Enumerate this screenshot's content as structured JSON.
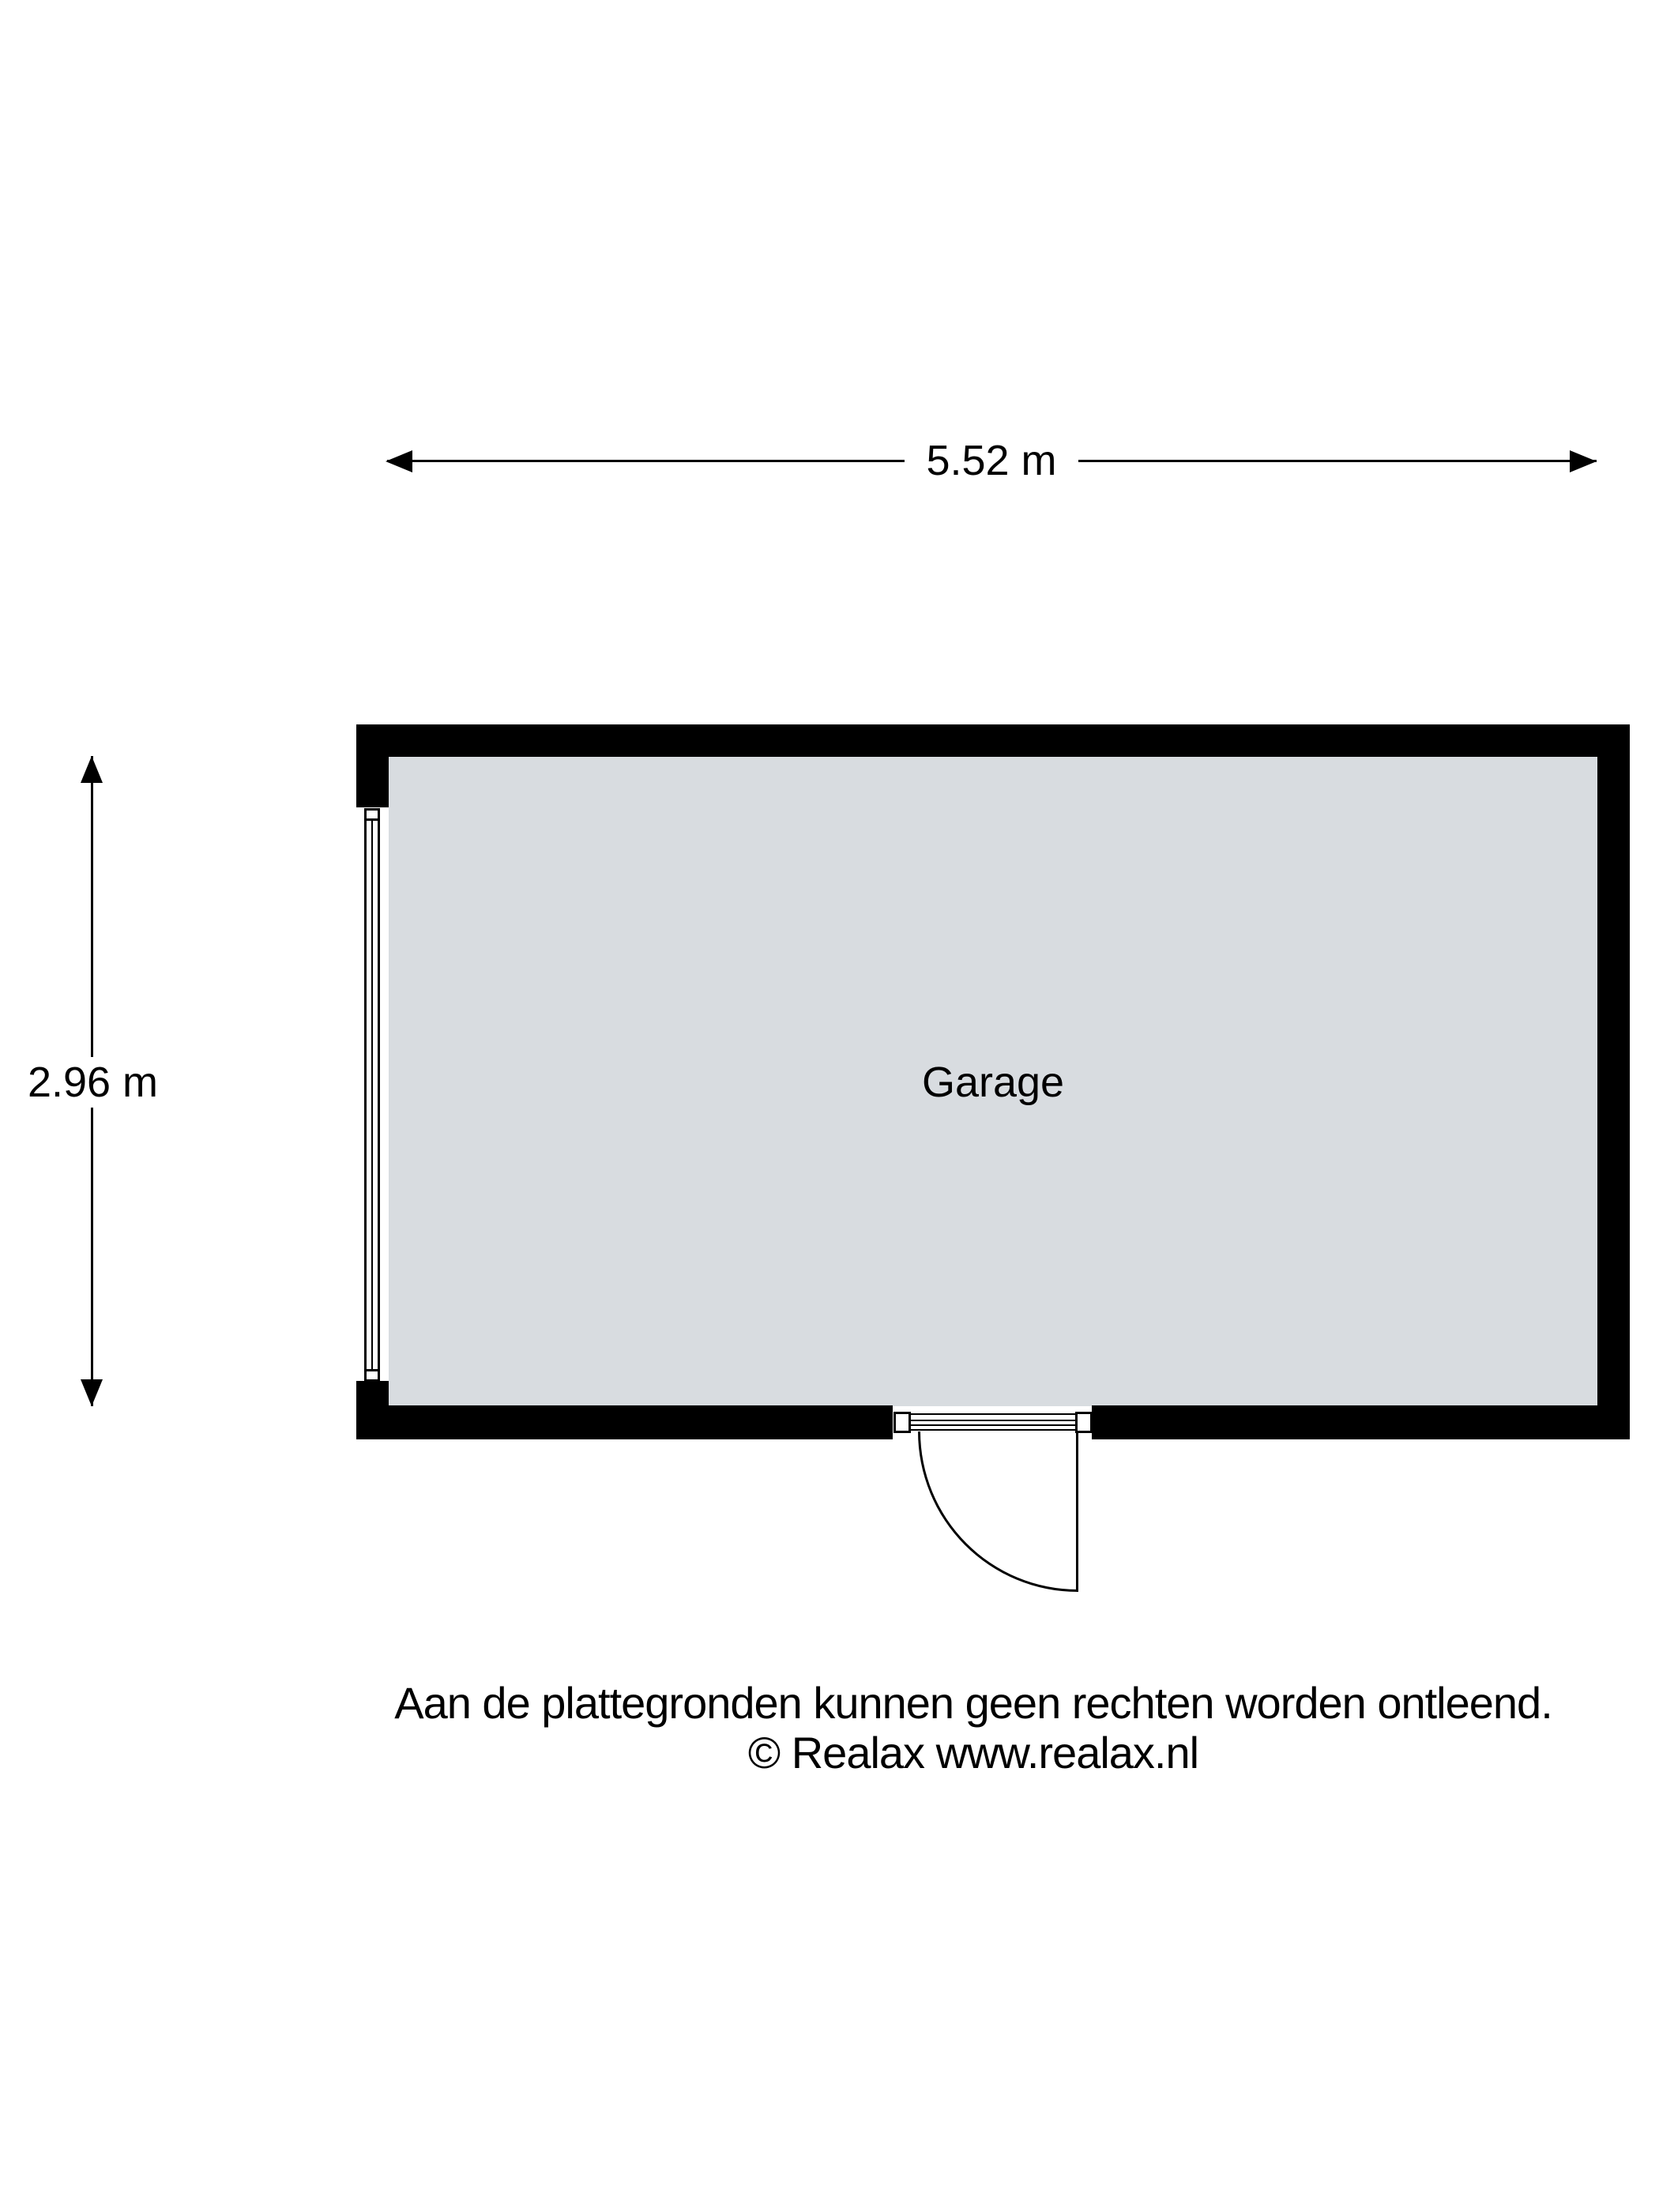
{
  "floorplan": {
    "room": {
      "label": "Garage"
    },
    "dimensions": {
      "width_label": "5.52 m",
      "height_label": "2.96 m"
    },
    "footer": {
      "line1": "Aan de plattegronden kunnen geen rechten worden ontleend.",
      "line2": "© Realax www.realax.nl"
    },
    "colors": {
      "wall": "#000000",
      "floor": "#d8dce0",
      "background": "#ffffff",
      "line": "#000000"
    }
  }
}
